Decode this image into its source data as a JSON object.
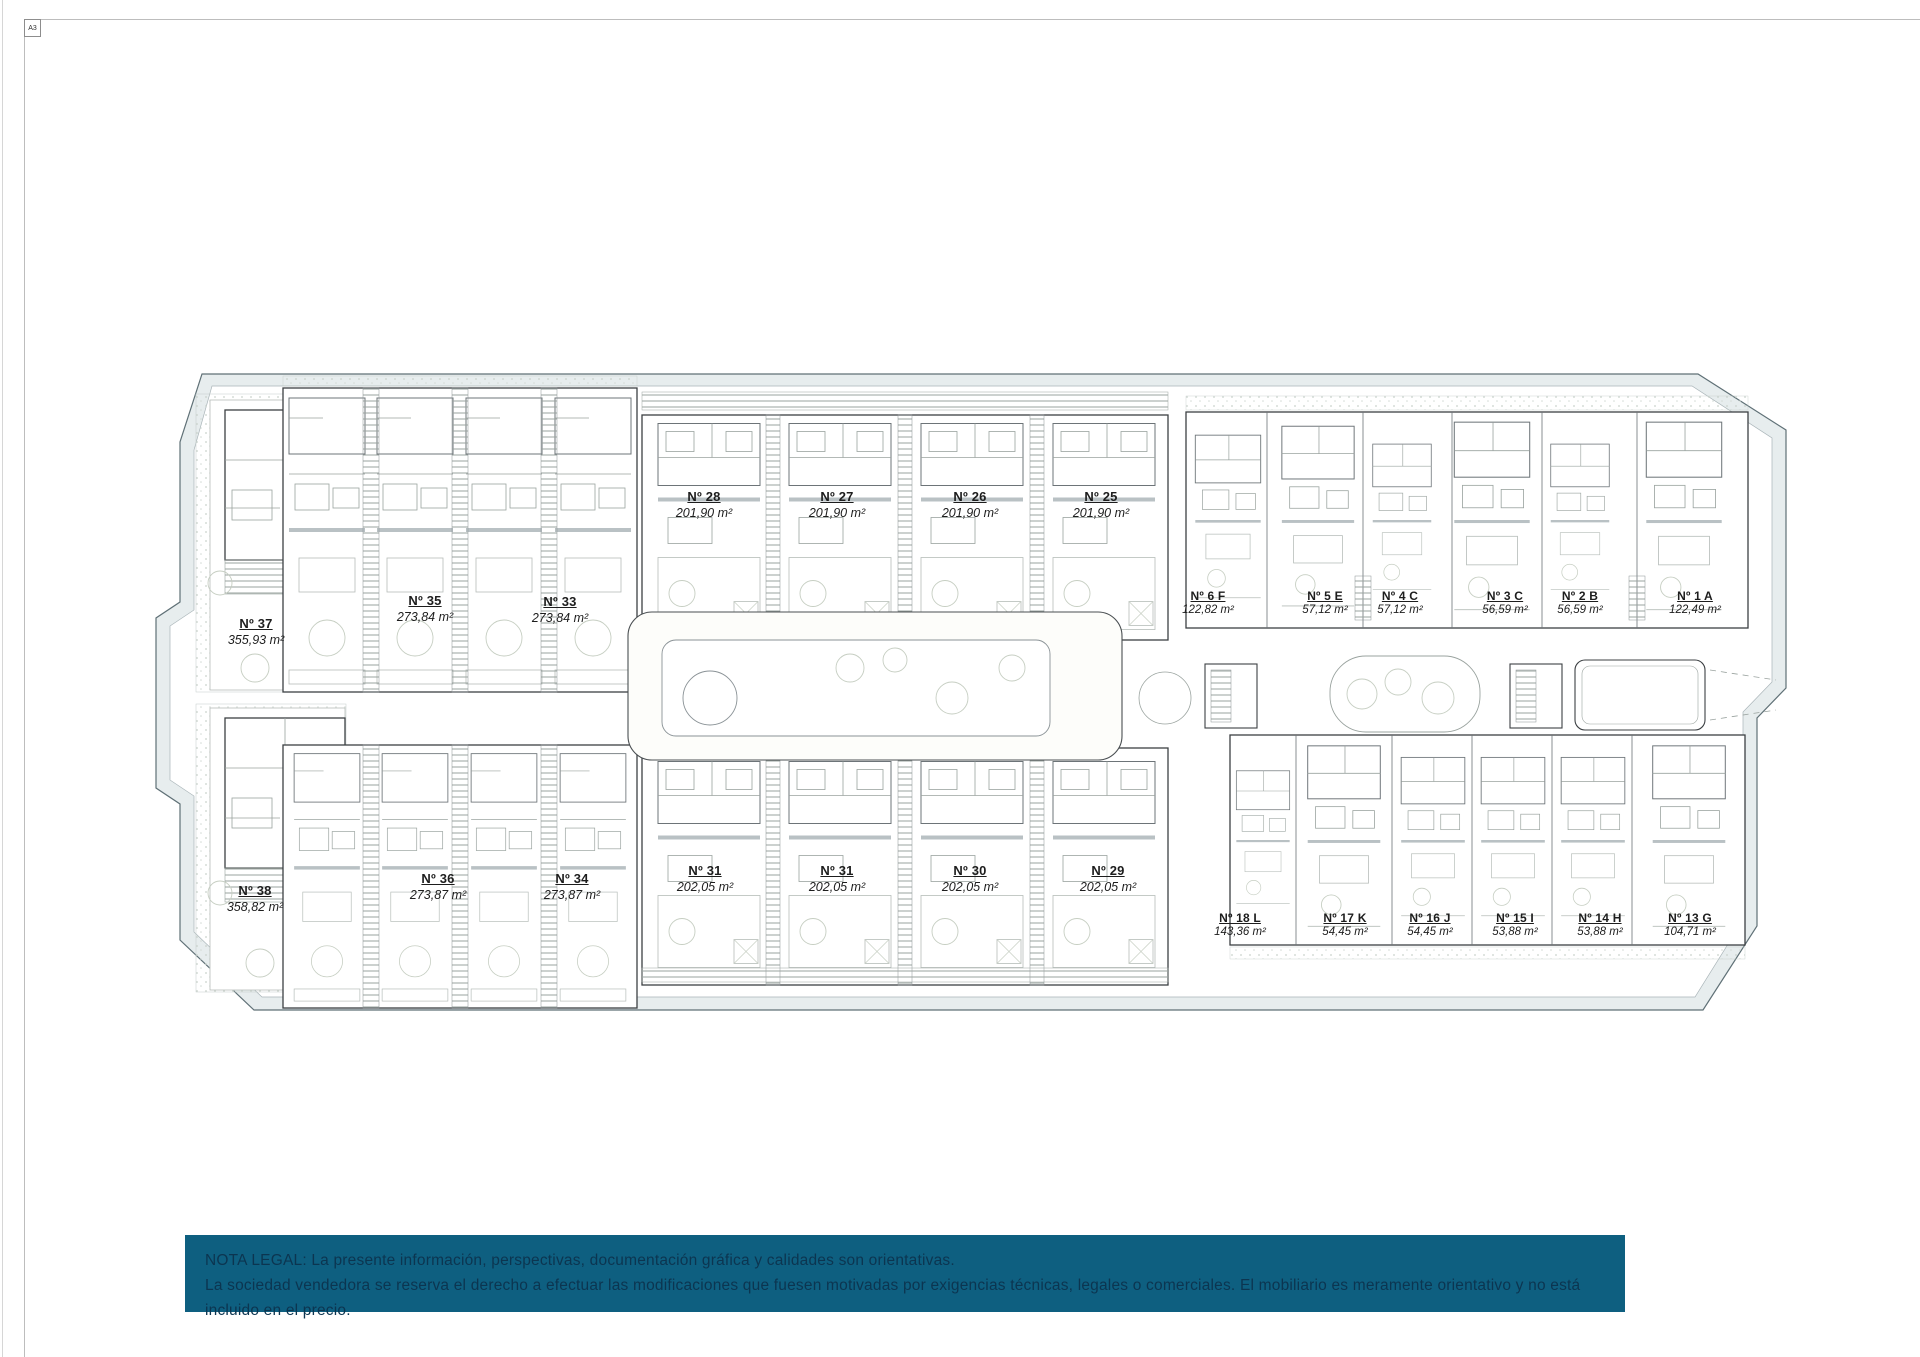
{
  "sheet": {
    "format_label": "A3"
  },
  "plan": {
    "units": [
      {
        "name": "Nº 37",
        "area": "355,93 m²"
      },
      {
        "name": "Nº 35",
        "area": "273,84 m²"
      },
      {
        "name": "Nº 33",
        "area": "273,84 m²"
      },
      {
        "name": "Nº 28",
        "area": "201,90 m²"
      },
      {
        "name": "Nº 27",
        "area": "201,90 m²"
      },
      {
        "name": "Nº 26",
        "area": "201,90 m²"
      },
      {
        "name": "Nº 25",
        "area": "201,90 m²"
      },
      {
        "name": "Nº 6 F",
        "area": "122,82 m²"
      },
      {
        "name": "Nº 5 E",
        "area": "57,12 m²"
      },
      {
        "name": "Nº 4 C",
        "area": "57,12 m²"
      },
      {
        "name": "Nº 3 C",
        "area": "56,59 m²"
      },
      {
        "name": "Nº 2 B",
        "area": "56,59 m²"
      },
      {
        "name": "Nº 1 A",
        "area": "122,49 m²"
      },
      {
        "name": "Nº 38",
        "area": "358,82 m²"
      },
      {
        "name": "Nº 36",
        "area": "273,87 m²"
      },
      {
        "name": "Nº 34",
        "area": "273,87 m²"
      },
      {
        "name": "Nº 31",
        "area": "202,05 m²"
      },
      {
        "name": "Nº 31",
        "area": "202,05 m²"
      },
      {
        "name": "Nº 30",
        "area": "202,05 m²"
      },
      {
        "name": "Nº 29",
        "area": "202,05 m²"
      },
      {
        "name": "Nº 18 L",
        "area": "143,36 m²"
      },
      {
        "name": "Nº 17 K",
        "area": "54,45 m²"
      },
      {
        "name": "Nº 16 J",
        "area": "54,45 m²"
      },
      {
        "name": "Nº 15 I",
        "area": "53,88 m²"
      },
      {
        "name": "Nº 14 H",
        "area": "53,88 m²"
      },
      {
        "name": "Nº 13 G",
        "area": "104,71 m²"
      }
    ]
  },
  "legal_note": {
    "line1": "NOTA LEGAL: La presente información, perspectivas, documentación gráfica y calidades son orientativas.",
    "line2": "La sociedad vendedora se reserva el derecho a efectuar las modificaciones que fuesen motivadas por exigencias técnicas, legales o comerciales. El mobiliario es meramente orientativo y no está incluido en el precio.",
    "bar_color": "#0e5f80",
    "text_color": "#0c3550"
  }
}
